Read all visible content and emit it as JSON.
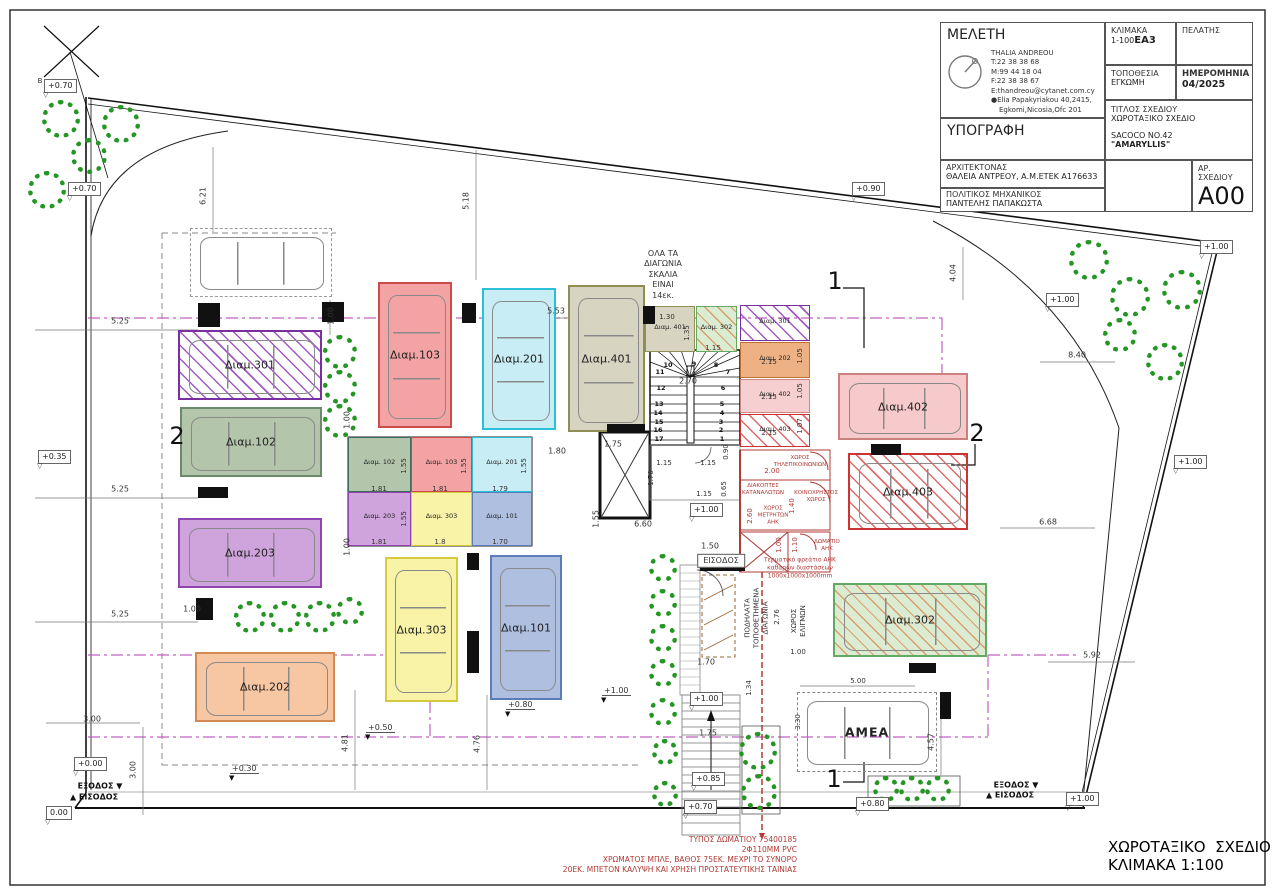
{
  "title_block": {
    "meleti_label": "ΜΕΛΕΤΗ",
    "firm_name": "THALIA ANDREOU",
    "phone": "T:22 38 38 68",
    "mobile": "M:99 44 18 04",
    "fax": "F:22 38 38 67",
    "email": "E:thandreou@cytanet.com.cy",
    "address1": "Elia Papakyriakou 40,2415,",
    "address2": "Egkomi,Nicosia,Ofc 201",
    "ypografi_label": "ΥΠΟΓΡΑΦΗ",
    "architect_label": "ΑΡΧΙΤΕΚΤΟΝΑΣ",
    "architect_name": "ΘΑΛΕΙΑ ΑΝΤΡΕΟΥ, Α.Μ.ΕΤΕΚ Α176633",
    "engineer_label": "ΠΟΛΙΤΙΚΟΣ ΜΗΧΑΝΙΚΟΣ",
    "engineer_name": "ΠΑΝΤΕΛΗΣ ΠΑΠΑΚΩΣΤΑ",
    "klimaka_label": "ΚΛΙΜΑΚΑ",
    "klimaka_value": "1-100",
    "klimaka_stamp": "ΕΑ3",
    "pelatis_label": "ΠΕΛΑΤΗΣ",
    "topothesia_label": "ΤΟΠΟΘΕΣΙΑ",
    "topothesia_value": "ΕΓΚΩΜΗ",
    "date_label": "ΗΜΕΡΟΜΗΝΙΑ",
    "date_value": "04/2025",
    "titlos_label": "ΤΙΤΛΟΣ ΣΧΕΔΙΟΥ",
    "titlos_value": "ΧΩΡΟΤΑΞΙΚΟ ΣΧΕΔΙΟ",
    "project_line1": "SACOCO NO.42",
    "project_line2": "\"AMARYLLIS\"",
    "sheet_label": "ΑΡ. ΣΧΕΔΙΟΥ",
    "sheet_value": "A00"
  },
  "footer": {
    "plan_title": "ΧΩΡΟΤΑΞΙΚΟ  ΣΧΕΔΙΟ",
    "plan_scale": "ΚΛΙΜΑΚΑ 1:100"
  },
  "plan": {
    "parking_spaces": [
      {
        "id": "p301",
        "label": "Διαμ.301",
        "fill": "none",
        "border": "#7a2fa0",
        "hatch": "purple"
      },
      {
        "id": "p102",
        "label": "Διαμ.102",
        "fill": "#b3c6ac",
        "border": "#6b8a6b"
      },
      {
        "id": "p203",
        "label": "Διαμ.203",
        "fill": "#cfa3dc",
        "border": "#9044b0"
      },
      {
        "id": "p202",
        "label": "Διαμ.202",
        "fill": "#f6c7a2",
        "border": "#d28a55"
      },
      {
        "id": "p103",
        "label": "Διαμ.103",
        "fill": "#f3a3a3",
        "border": "#cc4c4c"
      },
      {
        "id": "p201",
        "label": "Διαμ.201",
        "fill": "#c8edf4",
        "border": "#2cc0d8"
      },
      {
        "id": "p401",
        "label": "Διαμ.401",
        "fill": "#d8d4c2",
        "border": "#8f8f55"
      },
      {
        "id": "p303",
        "label": "Διαμ.303",
        "fill": "#f8f3a6",
        "border": "#d6c93e"
      },
      {
        "id": "p101",
        "label": "Διαμ.101",
        "fill": "#aebfe0",
        "border": "#5b7cbb"
      },
      {
        "id": "p402",
        "label": "Διαμ.402",
        "fill": "#f6caca",
        "border": "#cc8181"
      },
      {
        "id": "p403",
        "label": "Διαμ.403",
        "fill": "none",
        "border": "#cc3333",
        "hatch": "red"
      },
      {
        "id": "p302",
        "label": "Διαμ.302",
        "fill": "#dcecd2",
        "border": "#63a863",
        "hatch": "orange"
      },
      {
        "id": "pamea",
        "label": "ΑΜΕΑ",
        "fill": "none",
        "border": "#888888",
        "dashed": true,
        "bold": true
      },
      {
        "id": "pghost",
        "label": "",
        "fill": "none",
        "border": "#999999",
        "dashed": true
      }
    ],
    "storage_rooms": [
      {
        "id": "s102",
        "label": "Διαμ. 102",
        "fill": "#b3c6ac",
        "border": "#3d6b5e"
      },
      {
        "id": "s103",
        "label": "Διαμ. 103",
        "fill": "#f3a3a3",
        "border": "#cc4c4c"
      },
      {
        "id": "s201",
        "label": "Διαμ. 201",
        "fill": "#c8edf4",
        "border": "#2cc0d8"
      },
      {
        "id": "s203",
        "label": "Διαμ. 203",
        "fill": "#cfa3dc",
        "border": "#9044b0"
      },
      {
        "id": "s303",
        "label": "Διαμ. 303",
        "fill": "#f8f3a6",
        "border": "#d6c93e"
      },
      {
        "id": "s101",
        "label": "Διαμ. 101",
        "fill": "#aebfe0",
        "border": "#5b7cbb"
      },
      {
        "id": "s401",
        "label": "Διαμ. 401",
        "fill": "#d8d4c2",
        "border": "#8f8f55"
      },
      {
        "id": "s302",
        "label": "Διαμ. 302",
        "fill": "#dcecd2",
        "border": "#63a863",
        "hatch": "orange"
      },
      {
        "id": "s301",
        "label": "Διαμ. 301",
        "fill": "none",
        "border": "#7a2fa0",
        "hatch": "purple"
      },
      {
        "id": "s202",
        "label": "Διαμ. 202",
        "fill": "#eeb183",
        "border": "#c07030"
      },
      {
        "id": "s402",
        "label": "Διαμ. 402",
        "fill": "#f6d0d0",
        "border": "#cc8888"
      },
      {
        "id": "s403",
        "label": "Διαμ. 403",
        "fill": "none",
        "border": "#cc3333",
        "hatch": "red"
      }
    ],
    "level_markers": [
      {
        "id": "L1",
        "text": "+0.70"
      },
      {
        "id": "L2",
        "text": "+0.70"
      },
      {
        "id": "L3",
        "text": "+0.35"
      },
      {
        "id": "L4",
        "text": "+0.00"
      },
      {
        "id": "L5",
        "text": "0.00"
      },
      {
        "id": "L6",
        "text": "+0.30"
      },
      {
        "id": "L7",
        "text": "+0.50"
      },
      {
        "id": "L8",
        "text": "+0.80"
      },
      {
        "id": "L9",
        "text": "+1.00"
      },
      {
        "id": "L10",
        "text": "+1.00"
      },
      {
        "id": "L11",
        "text": "+0.90"
      },
      {
        "id": "L12",
        "text": "+1.00"
      },
      {
        "id": "L13",
        "text": "+1.00"
      },
      {
        "id": "L14",
        "text": "+1.00"
      },
      {
        "id": "L15",
        "text": "+1.00"
      },
      {
        "id": "L16",
        "text": "+0.80"
      },
      {
        "id": "L17",
        "text": "+1.00"
      },
      {
        "id": "L18",
        "text": "+0.85"
      },
      {
        "id": "L19",
        "text": "+0.70"
      }
    ],
    "annotations": [
      {
        "id": "d1",
        "text": "6.21"
      },
      {
        "id": "d2",
        "text": "5.18"
      },
      {
        "id": "d3",
        "text": "5.25"
      },
      {
        "id": "d4",
        "text": "5.25"
      },
      {
        "id": "d5",
        "text": "5.25"
      },
      {
        "id": "d6",
        "text": "3.00"
      },
      {
        "id": "d7",
        "text": "3.00"
      },
      {
        "id": "d8",
        "text": "4.81"
      },
      {
        "id": "d9",
        "text": "4.76"
      },
      {
        "id": "d10",
        "text": "5.53"
      },
      {
        "id": "d11",
        "text": "1.00"
      },
      {
        "id": "d12",
        "text": "1.00"
      },
      {
        "id": "d13",
        "text": "1.00"
      },
      {
        "id": "d14",
        "text": "1.00"
      },
      {
        "id": "d15",
        "text": "1.80"
      },
      {
        "id": "d16",
        "text": "1.75"
      },
      {
        "id": "d17",
        "text": "6.60"
      },
      {
        "id": "d18",
        "text": "1.55"
      },
      {
        "id": "d19",
        "text": "1.50"
      },
      {
        "id": "d20",
        "text": "1.70"
      },
      {
        "id": "d21",
        "text": "2.70"
      },
      {
        "id": "d22",
        "text": "1.15"
      },
      {
        "id": "d23",
        "text": "1.15"
      },
      {
        "id": "d24",
        "text": "0.90"
      },
      {
        "id": "d25",
        "text": "1.70"
      },
      {
        "id": "d26",
        "text": "0.65"
      },
      {
        "id": "d27",
        "text": "1.15"
      },
      {
        "id": "d28",
        "text": "1.30"
      },
      {
        "id": "d29",
        "text": "1.35"
      },
      {
        "id": "d30",
        "text": "1.15"
      },
      {
        "id": "d31",
        "text": "2.15"
      },
      {
        "id": "d32",
        "text": "2.15"
      },
      {
        "id": "d33",
        "text": "2.15"
      },
      {
        "id": "d34",
        "text": "1.05"
      },
      {
        "id": "d35",
        "text": "1.05"
      },
      {
        "id": "d36",
        "text": "1.07"
      },
      {
        "id": "d38",
        "text": "4.04"
      },
      {
        "id": "d39",
        "text": "8.40"
      },
      {
        "id": "d40",
        "text": "6.68"
      },
      {
        "id": "d41",
        "text": "5.92"
      },
      {
        "id": "d42",
        "text": "4.57"
      },
      {
        "id": "d43",
        "text": "1.34"
      },
      {
        "id": "d44",
        "text": "3.30"
      },
      {
        "id": "d45",
        "text": "5.00"
      },
      {
        "id": "d46",
        "text": "2.76"
      },
      {
        "id": "d47",
        "text": "1.00"
      },
      {
        "id": "d48",
        "text": "2.00"
      },
      {
        "id": "d49",
        "text": "2.60"
      },
      {
        "id": "d50",
        "text": "1.40"
      },
      {
        "id": "d51",
        "text": "1.00"
      },
      {
        "id": "d52",
        "text": "1.10"
      },
      {
        "id": "d53",
        "text": "1.75"
      },
      {
        "id": "d54",
        "text": "1.81"
      },
      {
        "id": "d55",
        "text": "1.81"
      },
      {
        "id": "d56",
        "text": "1.79"
      },
      {
        "id": "d57",
        "text": "1.81"
      },
      {
        "id": "d58",
        "text": "1.8"
      },
      {
        "id": "d59",
        "text": "1.70"
      },
      {
        "id": "d60",
        "text": "1.55"
      },
      {
        "id": "d61",
        "text": "1.55"
      },
      {
        "id": "d62",
        "text": "1.55"
      },
      {
        "id": "d63",
        "text": "1.55"
      },
      {
        "id": "st10",
        "text": "10"
      },
      {
        "id": "st9",
        "text": "9"
      },
      {
        "id": "st8",
        "text": "8"
      },
      {
        "id": "st7",
        "text": "7"
      },
      {
        "id": "st6",
        "text": "6"
      },
      {
        "id": "st5",
        "text": "5"
      },
      {
        "id": "st4",
        "text": "4"
      },
      {
        "id": "st3",
        "text": "3"
      },
      {
        "id": "st2",
        "text": "2"
      },
      {
        "id": "st1",
        "text": "1"
      },
      {
        "id": "st11",
        "text": "11"
      },
      {
        "id": "st12",
        "text": "12"
      },
      {
        "id": "st13",
        "text": "13"
      },
      {
        "id": "st14",
        "text": "14"
      },
      {
        "id": "st15",
        "text": "15"
      },
      {
        "id": "st16",
        "text": "16"
      },
      {
        "id": "st17",
        "text": "17"
      },
      {
        "id": "sec2L",
        "text": "2"
      },
      {
        "id": "sec2R",
        "text": "2"
      },
      {
        "id": "sec1T",
        "text": "1"
      },
      {
        "id": "sec1B",
        "text": "1"
      },
      {
        "id": "secB",
        "text": "B"
      },
      {
        "id": "dirExitL",
        "text": "ΕΞΟΔΟΣ ▼"
      },
      {
        "id": "dirEnterL",
        "text": "▲ ΕΙΣΟΔΟΣ"
      },
      {
        "id": "dirExitR",
        "text": "ΕΞΟΔΟΣ ▼"
      },
      {
        "id": "dirEnterR",
        "text": "▲ ΕΙΣΟΔΟΣ"
      }
    ],
    "notes": [
      {
        "id": "n1",
        "lines": [
          "ΟΛΑ ΤΑ",
          "ΔΙΑΓΩΝΙΑ",
          "ΣΚΑΛΙΑ",
          "ΕΙΝΑΙ",
          "14εκ."
        ]
      },
      {
        "id": "n2",
        "lines": [
          "ΕΙΣΟΔΟΣ"
        ]
      },
      {
        "id": "n3",
        "lines": [
          "ΠΟΔΗΛΑΤΑ",
          "ΤΟΠΟΘΕΤΗΜΕΝΑ",
          "ΔΙΑΓΩΝΙΑ"
        ]
      },
      {
        "id": "n4",
        "lines": [
          "ΧΩΡΟΣ",
          "ΕΛΙΓΜΩΝ"
        ]
      },
      {
        "id": "n5",
        "lines": [
          "ΧΩΡΟΣ",
          "ΤΗΛΕΠΙΚΟΙΝΩΝΙΩΝ"
        ]
      },
      {
        "id": "n6",
        "lines": [
          "ΔΙΑΚΟΠΤΕΣ",
          "ΚΑΤΑΝΑΛΩΤΩΝ"
        ]
      },
      {
        "id": "n7",
        "lines": [
          "ΚΟΙΝΟΧΡΗΣΤΟΣ",
          "ΧΩΡΟΣ"
        ]
      },
      {
        "id": "n8",
        "lines": [
          "ΧΩΡΟΣ",
          "ΜΕΤΡΗΤΩΝ",
          "ΑΗΚ"
        ]
      },
      {
        "id": "n9",
        "lines": [
          "ΔΩΜΑΤΙΟ",
          "ΑΗΚ"
        ]
      },
      {
        "id": "n10",
        "lines": [
          "Τερματικό φρεάτιο ΑΗΚ",
          "καθαρών διαστάσεων",
          "1000x1000x1000mm"
        ]
      },
      {
        "id": "n11",
        "lines": [
          "ΤΥΠΟΣ ΔΩΜΑΤΙΟΥ 75400185",
          "2Φ110ΜΜ PVC",
          "ΧΡΩΜΑΤΟΣ ΜΠΛΕ, ΒΑΘΟΣ 75ΕΚ. ΜΕΧΡΙ ΤΟ ΣΥΝΟΡΟ",
          "20ΕΚ. ΜΠΕΤΟΝ ΚΑΛΥΨΗ ΚΑΙ ΧΡΗΣΗ ΠΡΟΣΤΑΤΕΥΤΙΚΗΣ ΤΑΙΝΙΑΣ"
        ]
      }
    ]
  }
}
